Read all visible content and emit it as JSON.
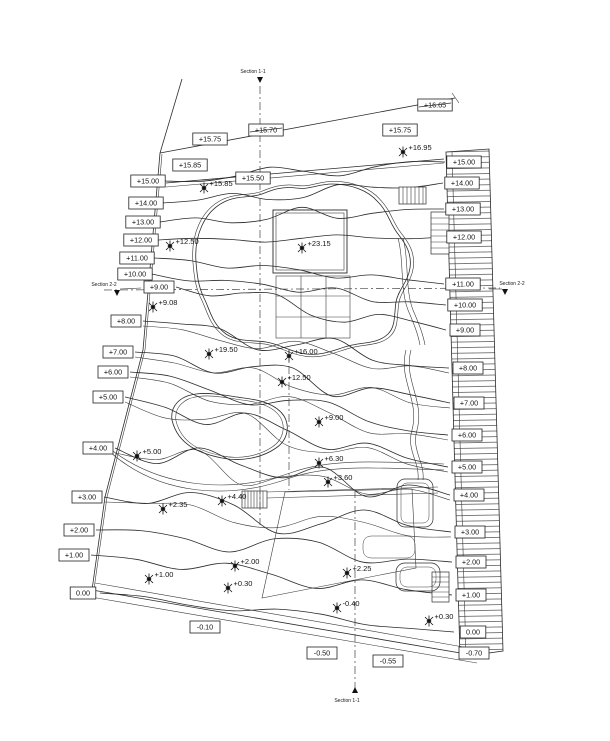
{
  "drawing": {
    "title": "site-grading-plan",
    "left_contour_labels": [
      {
        "text": "+15.00",
        "x": 148,
        "y": 181
      },
      {
        "text": "+14.00",
        "x": 146,
        "y": 203
      },
      {
        "text": "+13.00",
        "x": 143,
        "y": 222
      },
      {
        "text": "+12.00",
        "x": 141,
        "y": 240
      },
      {
        "text": "+11.00",
        "x": 137,
        "y": 258
      },
      {
        "text": "+10.00",
        "x": 135,
        "y": 274
      },
      {
        "text": "+9.00",
        "x": 159,
        "y": 287
      },
      {
        "text": "+8.00",
        "x": 126,
        "y": 321
      },
      {
        "text": "+7.00",
        "x": 118,
        "y": 352
      },
      {
        "text": "+6.00",
        "x": 113,
        "y": 372
      },
      {
        "text": "+5.00",
        "x": 108,
        "y": 397
      },
      {
        "text": "+4.00",
        "x": 98,
        "y": 448
      },
      {
        "text": "+3.00",
        "x": 87,
        "y": 497
      },
      {
        "text": "+2.00",
        "x": 79,
        "y": 530
      },
      {
        "text": "+1.00",
        "x": 74,
        "y": 555
      },
      {
        "text": "0.00",
        "x": 83,
        "y": 593
      }
    ],
    "right_contour_labels": [
      {
        "text": "+15.00",
        "x": 464,
        "y": 162
      },
      {
        "text": "+14.00",
        "x": 462,
        "y": 183
      },
      {
        "text": "+13.00",
        "x": 463,
        "y": 209
      },
      {
        "text": "+12.00",
        "x": 464,
        "y": 237
      },
      {
        "text": "+11.00",
        "x": 463,
        "y": 284
      },
      {
        "text": "+10.00",
        "x": 465,
        "y": 305
      },
      {
        "text": "+9.00",
        "x": 465,
        "y": 330
      },
      {
        "text": "+8.00",
        "x": 468,
        "y": 368
      },
      {
        "text": "+7.00",
        "x": 469,
        "y": 403
      },
      {
        "text": "+6.00",
        "x": 467,
        "y": 435
      },
      {
        "text": "+5.00",
        "x": 467,
        "y": 467
      },
      {
        "text": "+4.00",
        "x": 469,
        "y": 495
      },
      {
        "text": "+3.00",
        "x": 470,
        "y": 532
      },
      {
        "text": "+2.00",
        "x": 471,
        "y": 562
      },
      {
        "text": "+1.00",
        "x": 471,
        "y": 595
      },
      {
        "text": "0.00",
        "x": 473,
        "y": 632
      },
      {
        "text": "-0.70",
        "x": 474,
        "y": 653
      }
    ],
    "boundary_labels": [
      {
        "text": "+15.75",
        "x": 210,
        "y": 139,
        "strike": false
      },
      {
        "text": "+15.70",
        "x": 266,
        "y": 130,
        "strike": true
      },
      {
        "text": "+16.65",
        "x": 435,
        "y": 105,
        "strike": true
      },
      {
        "text": "+15.75",
        "x": 400,
        "y": 130,
        "strike": false
      },
      {
        "text": "+15.85",
        "x": 190,
        "y": 165,
        "strike": false
      },
      {
        "text": "+15.50",
        "x": 253,
        "y": 178,
        "strike": false
      },
      {
        "text": "-0.10",
        "x": 205,
        "y": 627,
        "strike": false
      },
      {
        "text": "-0.50",
        "x": 322,
        "y": 653,
        "strike": false
      },
      {
        "text": "-0.55",
        "x": 388,
        "y": 661,
        "strike": false
      }
    ],
    "spot_elevations": [
      {
        "text": "+15.85",
        "x": 204,
        "y": 188
      },
      {
        "text": "+16.95",
        "x": 403,
        "y": 152
      },
      {
        "text": "+23.15",
        "x": 302,
        "y": 248
      },
      {
        "text": "+12.50",
        "x": 170,
        "y": 246
      },
      {
        "text": "+9.08",
        "x": 153,
        "y": 307
      },
      {
        "text": "+19.50",
        "x": 209,
        "y": 354
      },
      {
        "text": "+16.00",
        "x": 289,
        "y": 356
      },
      {
        "text": "+12.50",
        "x": 282,
        "y": 382
      },
      {
        "text": "+9.00",
        "x": 319,
        "y": 422
      },
      {
        "text": "+6.30",
        "x": 319,
        "y": 463
      },
      {
        "text": "+3.60",
        "x": 328,
        "y": 482
      },
      {
        "text": "+5.00",
        "x": 137,
        "y": 456
      },
      {
        "text": "+2.35",
        "x": 163,
        "y": 509
      },
      {
        "text": "+4.40",
        "x": 222,
        "y": 501
      },
      {
        "text": "+2.00",
        "x": 235,
        "y": 566
      },
      {
        "text": "+0.30",
        "x": 228,
        "y": 588
      },
      {
        "text": "+1.00",
        "x": 149,
        "y": 579
      },
      {
        "text": "+2.25",
        "x": 347,
        "y": 573
      },
      {
        "text": "-0.40",
        "x": 337,
        "y": 608
      },
      {
        "text": "+0.30",
        "x": 429,
        "y": 621
      }
    ],
    "section_markers": [
      {
        "label": "Section 1-1",
        "x": 253,
        "y": 73,
        "ax": 260,
        "ay": 80,
        "dir": "down"
      },
      {
        "label": "Section 2-2",
        "x": 104,
        "y": 286,
        "ax": 117,
        "ay": 293,
        "dir": "down",
        "leader": [
          120,
          289,
          141,
          288
        ]
      },
      {
        "label": "Section 2-2",
        "x": 512,
        "y": 285,
        "ax": 505,
        "ay": 292,
        "dir": "down",
        "leader": [
          489,
          289,
          502,
          289
        ]
      },
      {
        "label": "Section 1-1",
        "x": 347,
        "y": 702,
        "ax": 355,
        "ay": 690,
        "dir": "up"
      }
    ],
    "line_color": "#2b2b2b",
    "paper_color": "#ffffff"
  }
}
